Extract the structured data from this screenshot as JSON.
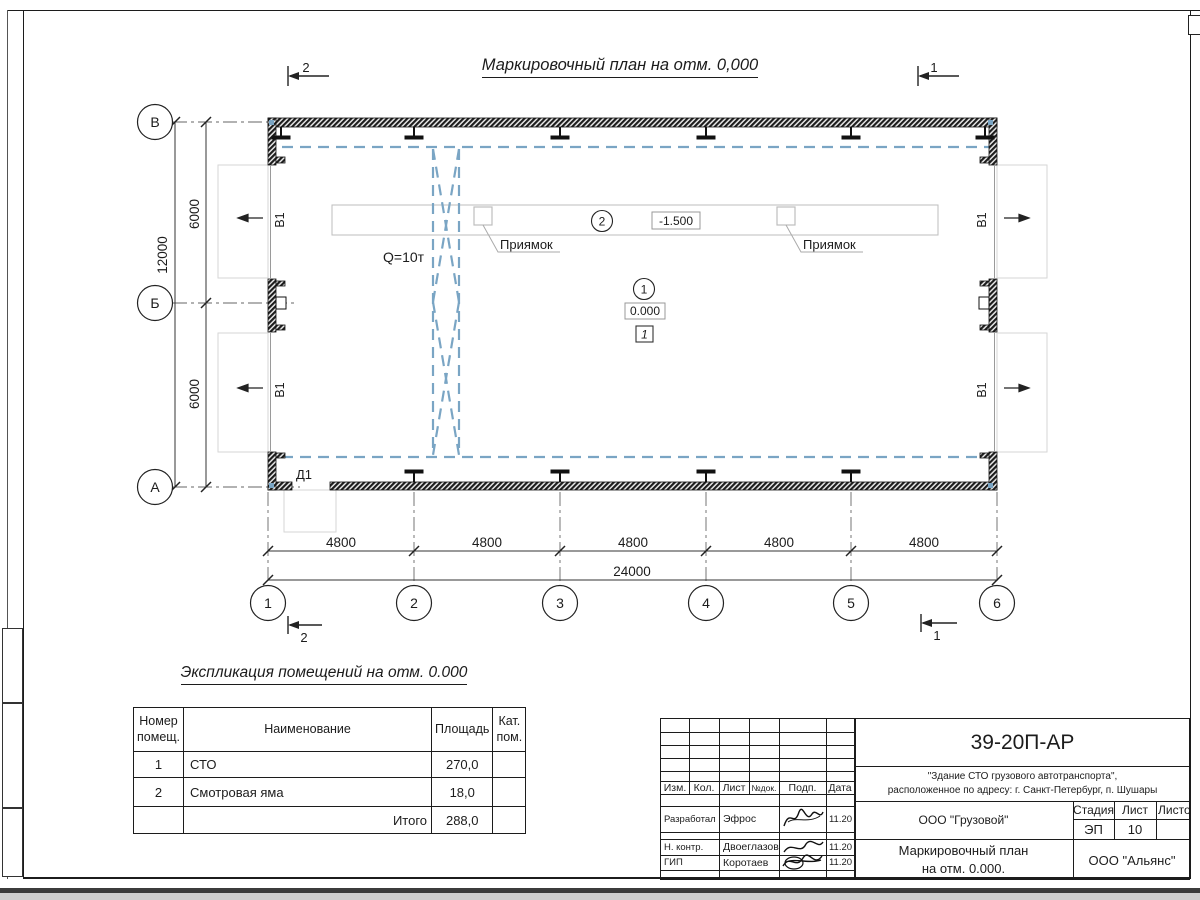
{
  "colors": {
    "accent_blue": "#7aa5c4",
    "line": "#1c1c1c",
    "faint": "#d6d6d6"
  },
  "title": "Маркировочный план на отм. 0,000",
  "plan": {
    "row_axes": [
      "В",
      "Б",
      "А"
    ],
    "col_axes": [
      "1",
      "2",
      "3",
      "4",
      "5",
      "6"
    ],
    "bay_dims": [
      "4800",
      "4800",
      "4800",
      "4800",
      "4800"
    ],
    "total_dim": "24000",
    "side_dims": [
      "6000",
      "6000"
    ],
    "side_total": "12000",
    "crane_label": "Q=10т",
    "pit_label_1": "Приямок",
    "pit_label_2": "Приямок",
    "gate_label": "В1",
    "door_label": "Д1",
    "pit_level": "-1.500",
    "floor_level": "0.000",
    "floor_type_mark": "1",
    "pit_marker": "2",
    "floor_marker": "1",
    "section_marks": {
      "top_left": "2",
      "top_right": "1",
      "bottom_left": "2",
      "bottom_right": "1"
    }
  },
  "explication": {
    "title": "Экспликация помещений на отм. 0.000",
    "header_num_1": "Номер",
    "header_num_2": "помещ.",
    "header_name": "Наименование",
    "header_area": "Площадь",
    "header_cat_1": "Кат.",
    "header_cat_2": "пом.",
    "rows": [
      {
        "num": "1",
        "name": "СТО",
        "area": "270,0",
        "cat": ""
      },
      {
        "num": "2",
        "name": "Смотровая яма",
        "area": "18,0",
        "cat": ""
      }
    ],
    "total_label": "Итого",
    "total_value": "288,0"
  },
  "titleblock": {
    "doc_number": "39-20П-АР",
    "object_line1": "\"Здание СТО грузового автотранспорта\",",
    "object_line2": "расположенное по адресу: г. Санкт-Петербург, п. Шушары",
    "rev_headers": [
      "Изм.",
      "Кол.",
      "Лист",
      "№док.",
      "Подп.",
      "Дата"
    ],
    "roles": [
      {
        "role": "Разработал",
        "name": "Эфрос",
        "date": "11.20"
      },
      {
        "role": "Н. контр.",
        "name": "Двоеглазов",
        "date": "11.20"
      },
      {
        "role": "ГИП",
        "name": "Коротаев",
        "date": "11.20"
      }
    ],
    "client": "ООО \"Грузовой\"",
    "sheet_title_line1": "Маркировочный план",
    "sheet_title_line2": "на отм. 0.000.",
    "stage_label": "Стадия",
    "sheet_label": "Лист",
    "sheets_label": "Листов",
    "stage_value": "ЭП",
    "sheet_value": "10",
    "company": "ООО \"Альянс\""
  }
}
